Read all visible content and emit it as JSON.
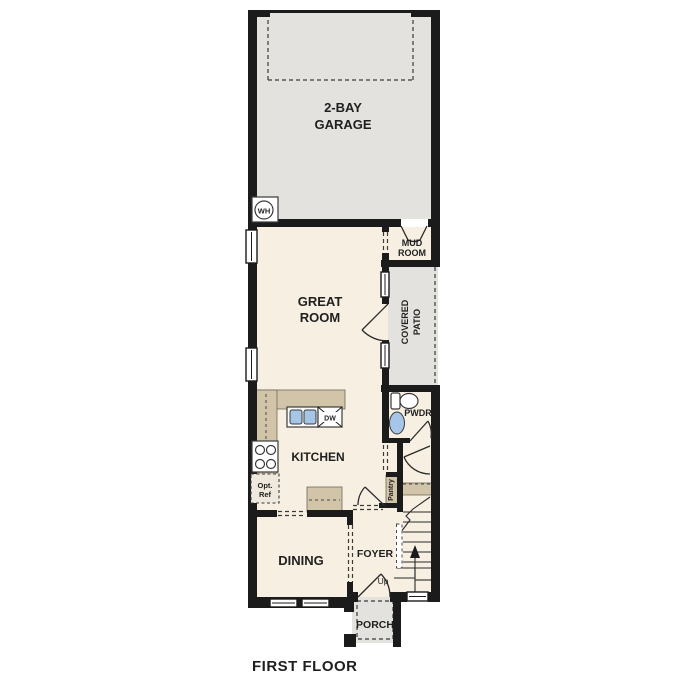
{
  "plan": {
    "caption": "FIRST FLOOR",
    "rooms": {
      "garage": {
        "line1": "2-BAY",
        "line2": "GARAGE"
      },
      "mud_room": {
        "line1": "MUD",
        "line2": "ROOM"
      },
      "great_room": {
        "line1": "GREAT",
        "line2": "ROOM"
      },
      "covered_patio": {
        "line1": "COVERED",
        "line2": "PATIO"
      },
      "powder_room": {
        "label": "PWDR"
      },
      "kitchen": {
        "label": "KITCHEN"
      },
      "pantry": {
        "label": "Pantry"
      },
      "dining": {
        "label": "DINING"
      },
      "foyer": {
        "label": "FOYER"
      },
      "porch": {
        "label": "PORCH"
      }
    },
    "annotations": {
      "water_heater": "WH",
      "dishwasher": "DW",
      "optional_ref_line1": "Opt.",
      "optional_ref_line2": "Ref",
      "stairs_up": "Up"
    },
    "colors": {
      "wall": "#1b1b1b",
      "interior": "#f7f0e2",
      "exterior_concrete": "#e3e2df",
      "cabinetry": "#d2c4a8",
      "plumbing_blue": "#a5c6e6",
      "background": "#ffffff"
    }
  }
}
